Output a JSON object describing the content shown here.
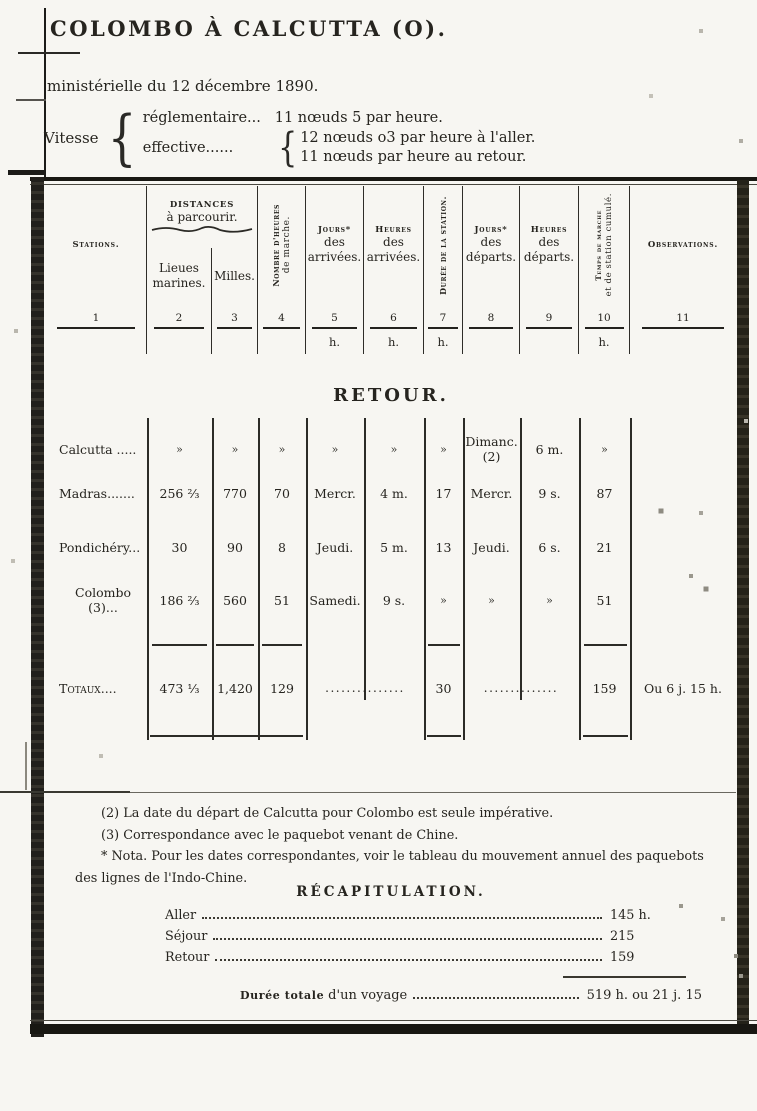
{
  "title": "COLOMBO À CALCUTTA (O).",
  "subtitle": "ministérielle du 12 décembre 1890.",
  "vitesse": {
    "label": "Vitesse",
    "reglementaire_label": "réglementaire...",
    "reglementaire_value": "11 nœuds 5 par heure.",
    "effective_label": "effective......",
    "effective_values": [
      "12 nœuds o3 par heure à l'aller.",
      "11 nœuds par heure au retour."
    ]
  },
  "table": {
    "header": {
      "stations": "Stations.",
      "distances_title": "DISTANCES",
      "distances_sub": "à parcourir.",
      "lieues_l1": "Lieues",
      "lieues_l2": "marines.",
      "milles": "Milles.",
      "nombre_heures_l1": "Nombre d'heures",
      "nombre_heures_l2": "de marche.",
      "jours_arr_l1": "Jours*",
      "jours_arr_l2": "des",
      "jours_arr_l3": "arrivées.",
      "heures_arr_l1": "Heures",
      "heures_arr_l2": "des",
      "heures_arr_l3": "arrivées.",
      "duree_station": "Durée de la station.",
      "jours_dep_l1": "Jours*",
      "jours_dep_l2": "des",
      "jours_dep_l3": "départs.",
      "heures_dep_l1": "Heures",
      "heures_dep_l2": "des",
      "heures_dep_l3": "départs.",
      "temps_l1": "Temps de marche",
      "temps_l2": "et de station cumulé.",
      "observations": "Observations."
    },
    "column_numbers": [
      "1",
      "2",
      "3",
      "4",
      "5",
      "6",
      "7",
      "8",
      "9",
      "10",
      "11"
    ],
    "unit_h": "h.",
    "section_title": "RETOUR.",
    "rows": [
      {
        "station": "Calcutta .....",
        "c2": "»",
        "c3": "»",
        "c4": "»",
        "c5": "»",
        "c6": "»",
        "c7": "»",
        "c8": "Dimanc.",
        "c8b": "(2)",
        "c9": "6 m.",
        "c10": "»",
        "c11": ""
      },
      {
        "station": "Madras.......",
        "c2": "256 ⅔",
        "c3": "770",
        "c4": "70",
        "c5": "Mercr.",
        "c6": "4 m.",
        "c7": "17",
        "c8": "Mercr.",
        "c8b": "",
        "c9": "9 s.",
        "c10": "87",
        "c11": ""
      },
      {
        "station": "Pondichéry...",
        "c2": "30",
        "c3": "90",
        "c4": "8",
        "c5": "Jeudi.",
        "c6": "5 m.",
        "c7": "13",
        "c8": "Jeudi.",
        "c8b": "",
        "c9": "6 s.",
        "c10": "21",
        "c11": ""
      },
      {
        "station": "Colombo (3)...",
        "c2": "186 ⅔",
        "c3": "560",
        "c4": "51",
        "c5": "Samedi.",
        "c6": "9 s.",
        "c7": "»",
        "c8": "»",
        "c8b": "",
        "c9": "»",
        "c10": "51",
        "c11": ""
      }
    ],
    "totals": {
      "station": "Totaux....",
      "c2": "473 ⅓",
      "c3": "1,420",
      "c4": "129",
      "c5_6": "...............",
      "c7": "30",
      "c8_9": "..............",
      "c10": "159",
      "c11": "Ou 6 j. 15 h."
    }
  },
  "footnotes": [
    "(2) La date du départ de Calcutta pour Colombo est seule impérative.",
    "(3) Correspondance avec le paquebot venant de Chine.",
    "* Nota. Pour les dates correspondantes, voir le tableau du mouvement annuel des paquebots des lignes de l'Indo-Chine."
  ],
  "recap": {
    "title": "RÉCAPITULATION.",
    "rows": [
      {
        "label": "Aller",
        "value": "145 h."
      },
      {
        "label": "Séjour",
        "value": "215"
      },
      {
        "label": "Retour",
        "value": "159"
      }
    ],
    "total_label_caps": "Durée totale",
    "total_label_rest": "d'un voyage",
    "total_value": "519 h. ou 21 j. 15"
  }
}
